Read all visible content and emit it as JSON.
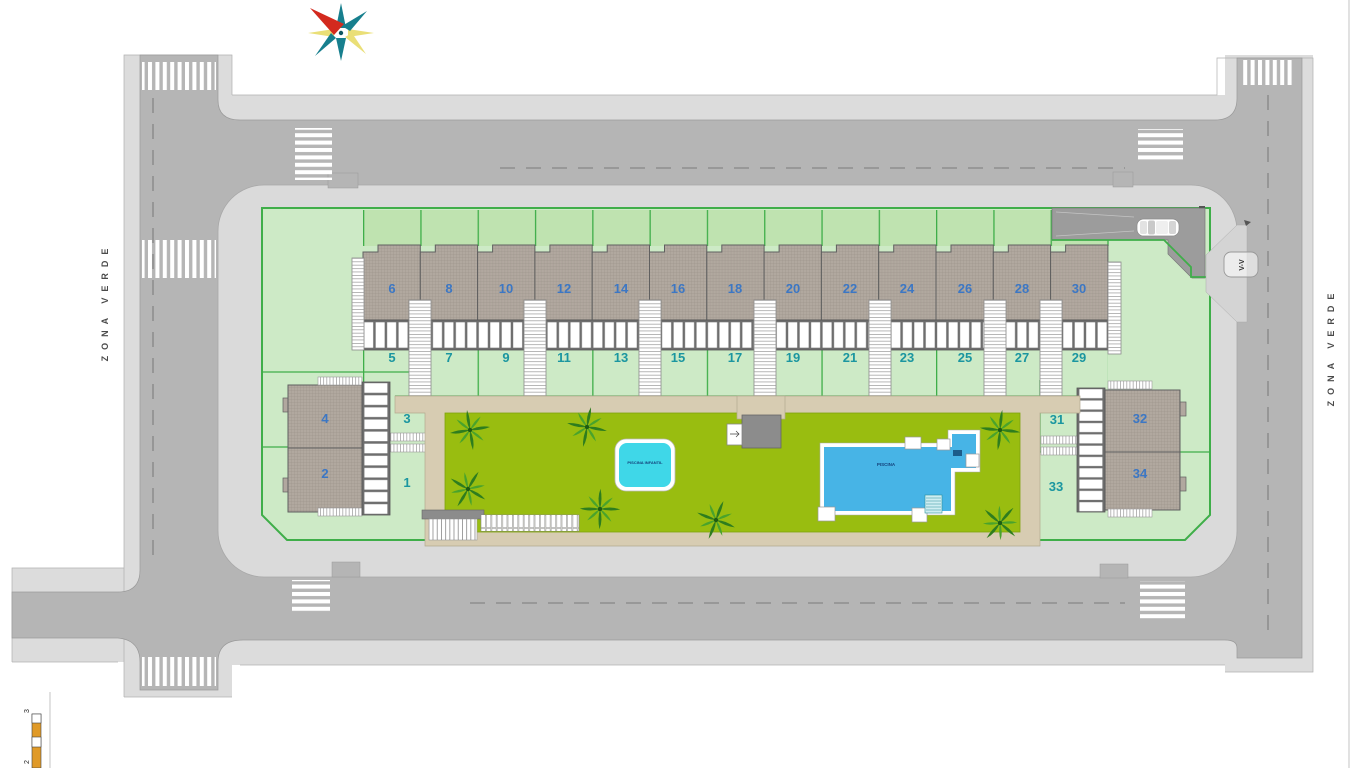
{
  "site_plan": {
    "zona_verde_left": "ZONA VERDE",
    "zona_verde_right": "ZONA VERDE",
    "visitor_parking_label": "V-V",
    "pools": {
      "small_label": "PISCINA INFANTIL",
      "large_label": "PISCINA"
    },
    "scale_bar": {
      "top": "3",
      "bottom": "2"
    },
    "units": {
      "row_top": [
        "6",
        "8",
        "10",
        "12",
        "14",
        "16",
        "18",
        "20",
        "22",
        "24",
        "26",
        "28",
        "30"
      ],
      "row_bottom": [
        "5",
        "7",
        "9",
        "11",
        "13",
        "15",
        "17",
        "19",
        "21",
        "23",
        "25",
        "27",
        "29"
      ],
      "left_block": {
        "roof_top": "4",
        "garden_top": "3",
        "roof_bottom": "2",
        "garden_bottom": "1"
      },
      "right_block": {
        "garden_top": "31",
        "roof_top": "32",
        "garden_bottom": "33",
        "roof_bottom": "34"
      }
    },
    "colors": {
      "road": "#b5b5b5",
      "sidewalk": "#dcdcdc",
      "plot_green": "#cdeac6",
      "lawn_green": "#99bd10",
      "accent_green": "#3fae49",
      "roof_gray": "#b1a89f",
      "walkway_tan": "#d7ccb2",
      "pool_small_blue": "#3fd7e8",
      "pool_large_blue": "#47b4e6",
      "number_blue": "#3c77c4",
      "number_teal": "#1b96a0"
    }
  }
}
